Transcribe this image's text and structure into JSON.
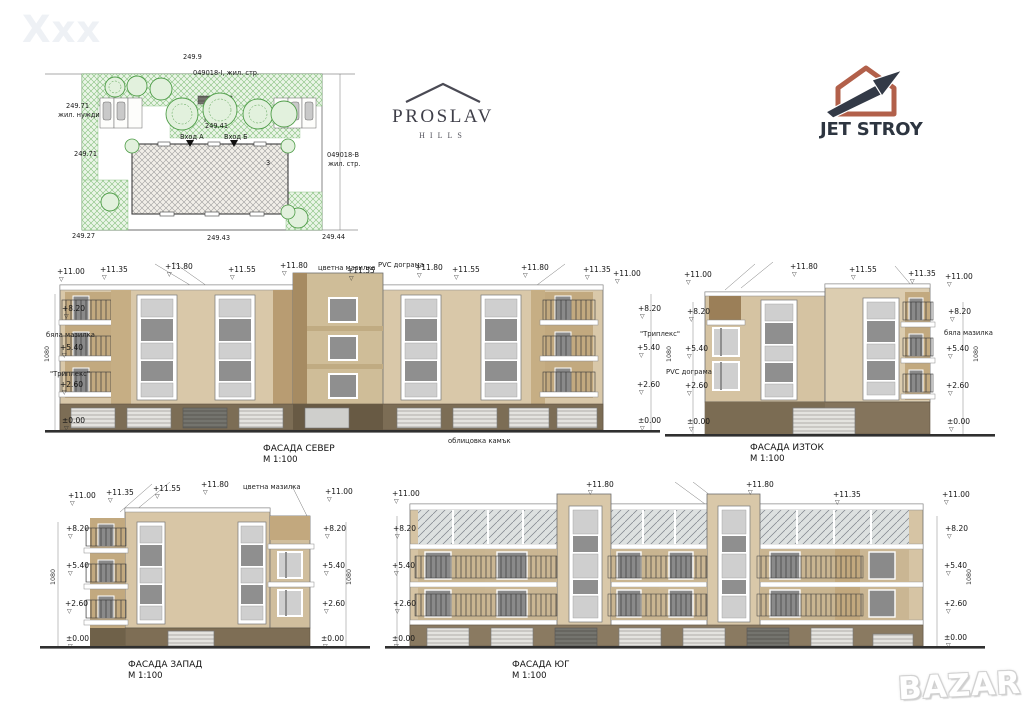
{
  "watermarks": {
    "top_left": "Xxx",
    "bottom_right": "BAZAR"
  },
  "logos": {
    "proslav": {
      "name": "PROSLAV",
      "subtitle": "HILLS"
    },
    "jetstroy": {
      "name": "JET STROY"
    }
  },
  "colors": {
    "wall_beige": "#d9c8a9",
    "wall_tan": "#c2a97f",
    "base_brown": "#7b6c53",
    "glass_gray": "#8f8f8f",
    "plan_green": "#5aa54e",
    "jetstroy_rust": "#b2604a",
    "jetstroy_dark": "#2d3540"
  },
  "site_plan": {
    "labels": [
      {
        "t": "249.9",
        "x": 183,
        "y": 54
      },
      {
        "t": "049018-I, жил. стр.",
        "x": 193,
        "y": 70
      },
      {
        "t": "249.71",
        "x": 66,
        "y": 103
      },
      {
        "t": "жил. нужди",
        "x": 58,
        "y": 112
      },
      {
        "t": "249.41",
        "x": 205,
        "y": 123
      },
      {
        "t": "Вход А",
        "x": 180,
        "y": 134
      },
      {
        "t": "Вход Б",
        "x": 224,
        "y": 134
      },
      {
        "t": "249.71",
        "x": 74,
        "y": 151
      },
      {
        "t": "049018-В",
        "x": 327,
        "y": 152
      },
      {
        "t": "жил. стр.",
        "x": 328,
        "y": 161
      },
      {
        "t": "3",
        "x": 266,
        "y": 160
      },
      {
        "t": "249.27",
        "x": 72,
        "y": 233
      },
      {
        "t": "249.43",
        "x": 207,
        "y": 235
      },
      {
        "t": "249.44",
        "x": 322,
        "y": 234
      }
    ]
  },
  "facades": {
    "north": {
      "caption": "ФАСАДА СЕВЕР",
      "scale": "М 1:100",
      "marks": [
        {
          "t": "+11.00",
          "x": 57,
          "y": 268,
          "k": "lvl"
        },
        {
          "t": "+11.35",
          "x": 100,
          "y": 266,
          "k": "lvl"
        },
        {
          "t": "+11.80",
          "x": 165,
          "y": 263,
          "k": "lvl"
        },
        {
          "t": "+11.55",
          "x": 228,
          "y": 266,
          "k": "lvl"
        },
        {
          "t": "+11.80",
          "x": 280,
          "y": 262,
          "k": "lvl"
        },
        {
          "t": "цветна мазилка",
          "x": 318,
          "y": 264,
          "k": "txt"
        },
        {
          "t": "+11.55",
          "x": 347,
          "y": 267,
          "k": "lvl"
        },
        {
          "t": "PVC дограма",
          "x": 378,
          "y": 261,
          "k": "txt"
        },
        {
          "t": "+11.80",
          "x": 415,
          "y": 264,
          "k": "lvl"
        },
        {
          "t": "+11.55",
          "x": 452,
          "y": 266,
          "k": "lvl"
        },
        {
          "t": "+11.80",
          "x": 521,
          "y": 264,
          "k": "lvl"
        },
        {
          "t": "+11.35",
          "x": 583,
          "y": 266,
          "k": "lvl"
        },
        {
          "t": "+11.00",
          "x": 613,
          "y": 270,
          "k": "lvl"
        },
        {
          "t": "+8.20",
          "x": 62,
          "y": 305,
          "k": "lvl"
        },
        {
          "t": "бяла мазилка",
          "x": 46,
          "y": 331,
          "k": "txt"
        },
        {
          "t": "+5.40",
          "x": 60,
          "y": 344,
          "k": "lvl"
        },
        {
          "t": "\"Триплекс\"",
          "x": 50,
          "y": 370,
          "k": "txt"
        },
        {
          "t": "+2.60",
          "x": 60,
          "y": 381,
          "k": "lvl"
        },
        {
          "t": "±0.00",
          "x": 62,
          "y": 417,
          "k": "lvl"
        },
        {
          "t": "1080",
          "x": 44,
          "y": 362,
          "k": "vdim"
        },
        {
          "t": "+8.20",
          "x": 638,
          "y": 305,
          "k": "lvl"
        },
        {
          "t": "\"Триплекс\"",
          "x": 640,
          "y": 330,
          "k": "txt"
        },
        {
          "t": "+5.40",
          "x": 637,
          "y": 344,
          "k": "lvl"
        },
        {
          "t": "+2.60",
          "x": 637,
          "y": 381,
          "k": "lvl"
        },
        {
          "t": "±0.00",
          "x": 638,
          "y": 417,
          "k": "lvl"
        },
        {
          "t": "1080",
          "x": 666,
          "y": 362,
          "k": "vdim"
        },
        {
          "t": "облицовка камък",
          "x": 448,
          "y": 437,
          "k": "txt"
        }
      ]
    },
    "east": {
      "caption": "ФАСАДА ИЗТОК",
      "scale": "М 1:100",
      "marks": [
        {
          "t": "+11.00",
          "x": 684,
          "y": 271,
          "k": "lvl"
        },
        {
          "t": "+11.80",
          "x": 790,
          "y": 263,
          "k": "lvl"
        },
        {
          "t": "+11.55",
          "x": 849,
          "y": 266,
          "k": "lvl"
        },
        {
          "t": "+11.35",
          "x": 908,
          "y": 270,
          "k": "lvl"
        },
        {
          "t": "+11.00",
          "x": 945,
          "y": 273,
          "k": "lvl"
        },
        {
          "t": "+8.20",
          "x": 687,
          "y": 308,
          "k": "lvl"
        },
        {
          "t": "+5.40",
          "x": 685,
          "y": 345,
          "k": "lvl"
        },
        {
          "t": "PVC дограма",
          "x": 666,
          "y": 368,
          "k": "txt"
        },
        {
          "t": "+2.60",
          "x": 685,
          "y": 382,
          "k": "lvl"
        },
        {
          "t": "±0.00",
          "x": 687,
          "y": 418,
          "k": "lvl"
        },
        {
          "t": "+8.20",
          "x": 948,
          "y": 308,
          "k": "lvl"
        },
        {
          "t": "бяла мазилка",
          "x": 944,
          "y": 329,
          "k": "txt"
        },
        {
          "t": "+5.40",
          "x": 946,
          "y": 345,
          "k": "lvl"
        },
        {
          "t": "+2.60",
          "x": 946,
          "y": 382,
          "k": "lvl"
        },
        {
          "t": "±0.00",
          "x": 947,
          "y": 418,
          "k": "lvl"
        },
        {
          "t": "1080",
          "x": 973,
          "y": 362,
          "k": "vdim"
        }
      ]
    },
    "west": {
      "caption": "ФАСАДА ЗАПАД",
      "scale": "М 1:100",
      "marks": [
        {
          "t": "+11.00",
          "x": 68,
          "y": 492,
          "k": "lvl"
        },
        {
          "t": "+11.35",
          "x": 106,
          "y": 489,
          "k": "lvl"
        },
        {
          "t": "+11.55",
          "x": 153,
          "y": 485,
          "k": "lvl"
        },
        {
          "t": "+11.80",
          "x": 201,
          "y": 481,
          "k": "lvl"
        },
        {
          "t": "цветна мазилка",
          "x": 243,
          "y": 483,
          "k": "txt"
        },
        {
          "t": "+11.00",
          "x": 325,
          "y": 488,
          "k": "lvl"
        },
        {
          "t": "+8.20",
          "x": 66,
          "y": 525,
          "k": "lvl"
        },
        {
          "t": "+5.40",
          "x": 66,
          "y": 562,
          "k": "lvl"
        },
        {
          "t": "+2.60",
          "x": 65,
          "y": 600,
          "k": "lvl"
        },
        {
          "t": "±0.00",
          "x": 66,
          "y": 635,
          "k": "lvl"
        },
        {
          "t": "1080",
          "x": 50,
          "y": 585,
          "k": "vdim"
        },
        {
          "t": "+8.20",
          "x": 323,
          "y": 525,
          "k": "lvl"
        },
        {
          "t": "+5.40",
          "x": 322,
          "y": 562,
          "k": "lvl"
        },
        {
          "t": "+2.60",
          "x": 322,
          "y": 600,
          "k": "lvl"
        },
        {
          "t": "±0.00",
          "x": 321,
          "y": 635,
          "k": "lvl"
        },
        {
          "t": "1080",
          "x": 346,
          "y": 585,
          "k": "vdim"
        }
      ]
    },
    "south": {
      "caption": "ФАСАДА ЮГ",
      "scale": "М 1:100",
      "marks": [
        {
          "t": "+11.00",
          "x": 392,
          "y": 490,
          "k": "lvl"
        },
        {
          "t": "+11.80",
          "x": 586,
          "y": 481,
          "k": "lvl"
        },
        {
          "t": "+11.80",
          "x": 746,
          "y": 481,
          "k": "lvl"
        },
        {
          "t": "+11.35",
          "x": 833,
          "y": 491,
          "k": "lvl"
        },
        {
          "t": "+11.00",
          "x": 942,
          "y": 491,
          "k": "lvl"
        },
        {
          "t": "+8.20",
          "x": 393,
          "y": 525,
          "k": "lvl"
        },
        {
          "t": "+5.40",
          "x": 392,
          "y": 562,
          "k": "lvl"
        },
        {
          "t": "+2.60",
          "x": 393,
          "y": 600,
          "k": "lvl"
        },
        {
          "t": "±0.00",
          "x": 392,
          "y": 635,
          "k": "lvl"
        },
        {
          "t": "+8.20",
          "x": 945,
          "y": 525,
          "k": "lvl"
        },
        {
          "t": "+5.40",
          "x": 944,
          "y": 562,
          "k": "lvl"
        },
        {
          "t": "+2.60",
          "x": 944,
          "y": 600,
          "k": "lvl"
        },
        {
          "t": "±0.00",
          "x": 944,
          "y": 634,
          "k": "lvl"
        },
        {
          "t": "1080",
          "x": 966,
          "y": 585,
          "k": "vdim"
        }
      ]
    }
  }
}
